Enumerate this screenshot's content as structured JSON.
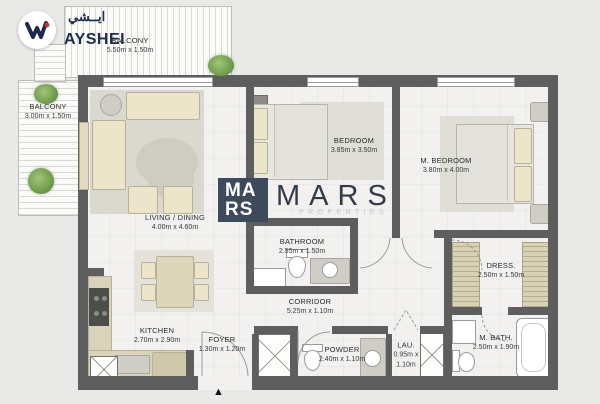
{
  "branding": {
    "logo_text": "AYSHEI",
    "logo_arabic": "ايــشي",
    "watermark": {
      "tile_line1": "MA",
      "tile_line2": "RS",
      "name": "MARS",
      "subtitle": "PROPERTIES"
    }
  },
  "entrance": {
    "marker": "▲"
  },
  "rooms": [
    {
      "id": "balcony-top",
      "name": "BALCONY",
      "dims": "5.50m x 1.50m"
    },
    {
      "id": "balcony-left",
      "name": "BALCONY",
      "dims": "3.00m x 1.50m"
    },
    {
      "id": "living",
      "name": "LIVING / DINING",
      "dims": "4.00m x 4.60m"
    },
    {
      "id": "bedroom",
      "name": "BEDROOM",
      "dims": "3.85m x 3.50m"
    },
    {
      "id": "m-bedroom",
      "name": "M. BEDROOM",
      "dims": "3.80m x 4.00m"
    },
    {
      "id": "bathroom",
      "name": "BATHROOM",
      "dims": "2.55m x 1.50m"
    },
    {
      "id": "corridor",
      "name": "CORRIDOR",
      "dims": "5.25m x 1.10m"
    },
    {
      "id": "kitchen",
      "name": "KITCHEN",
      "dims": "2.70m x 2.90m"
    },
    {
      "id": "foyer",
      "name": "FOYER",
      "dims": "1.30m x 1.20m"
    },
    {
      "id": "powder",
      "name": "POWDER",
      "dims": "2.40m x 1.10m"
    },
    {
      "id": "laundry",
      "name": "LAU.",
      "dims": "0.95m x 1.10m"
    },
    {
      "id": "dress",
      "name": "DRESS.",
      "dims": "2.50m x 1.50m"
    },
    {
      "id": "m-bath",
      "name": "M. BATH.",
      "dims": "2.50m x 1.90m"
    }
  ],
  "colors": {
    "background": "#e9e9e7",
    "wall": "#5e5e5e",
    "floor": "#f2f1ef",
    "rug": "#dbd8cf",
    "furniture_cream": "#ece5c9",
    "wardrobe_wood": "#d8d2b4",
    "brand_navy": "#1e2b4c",
    "brand_red": "#c0392b",
    "watermark_navy": "#3e4a5c",
    "plant_green": "#79a356"
  }
}
